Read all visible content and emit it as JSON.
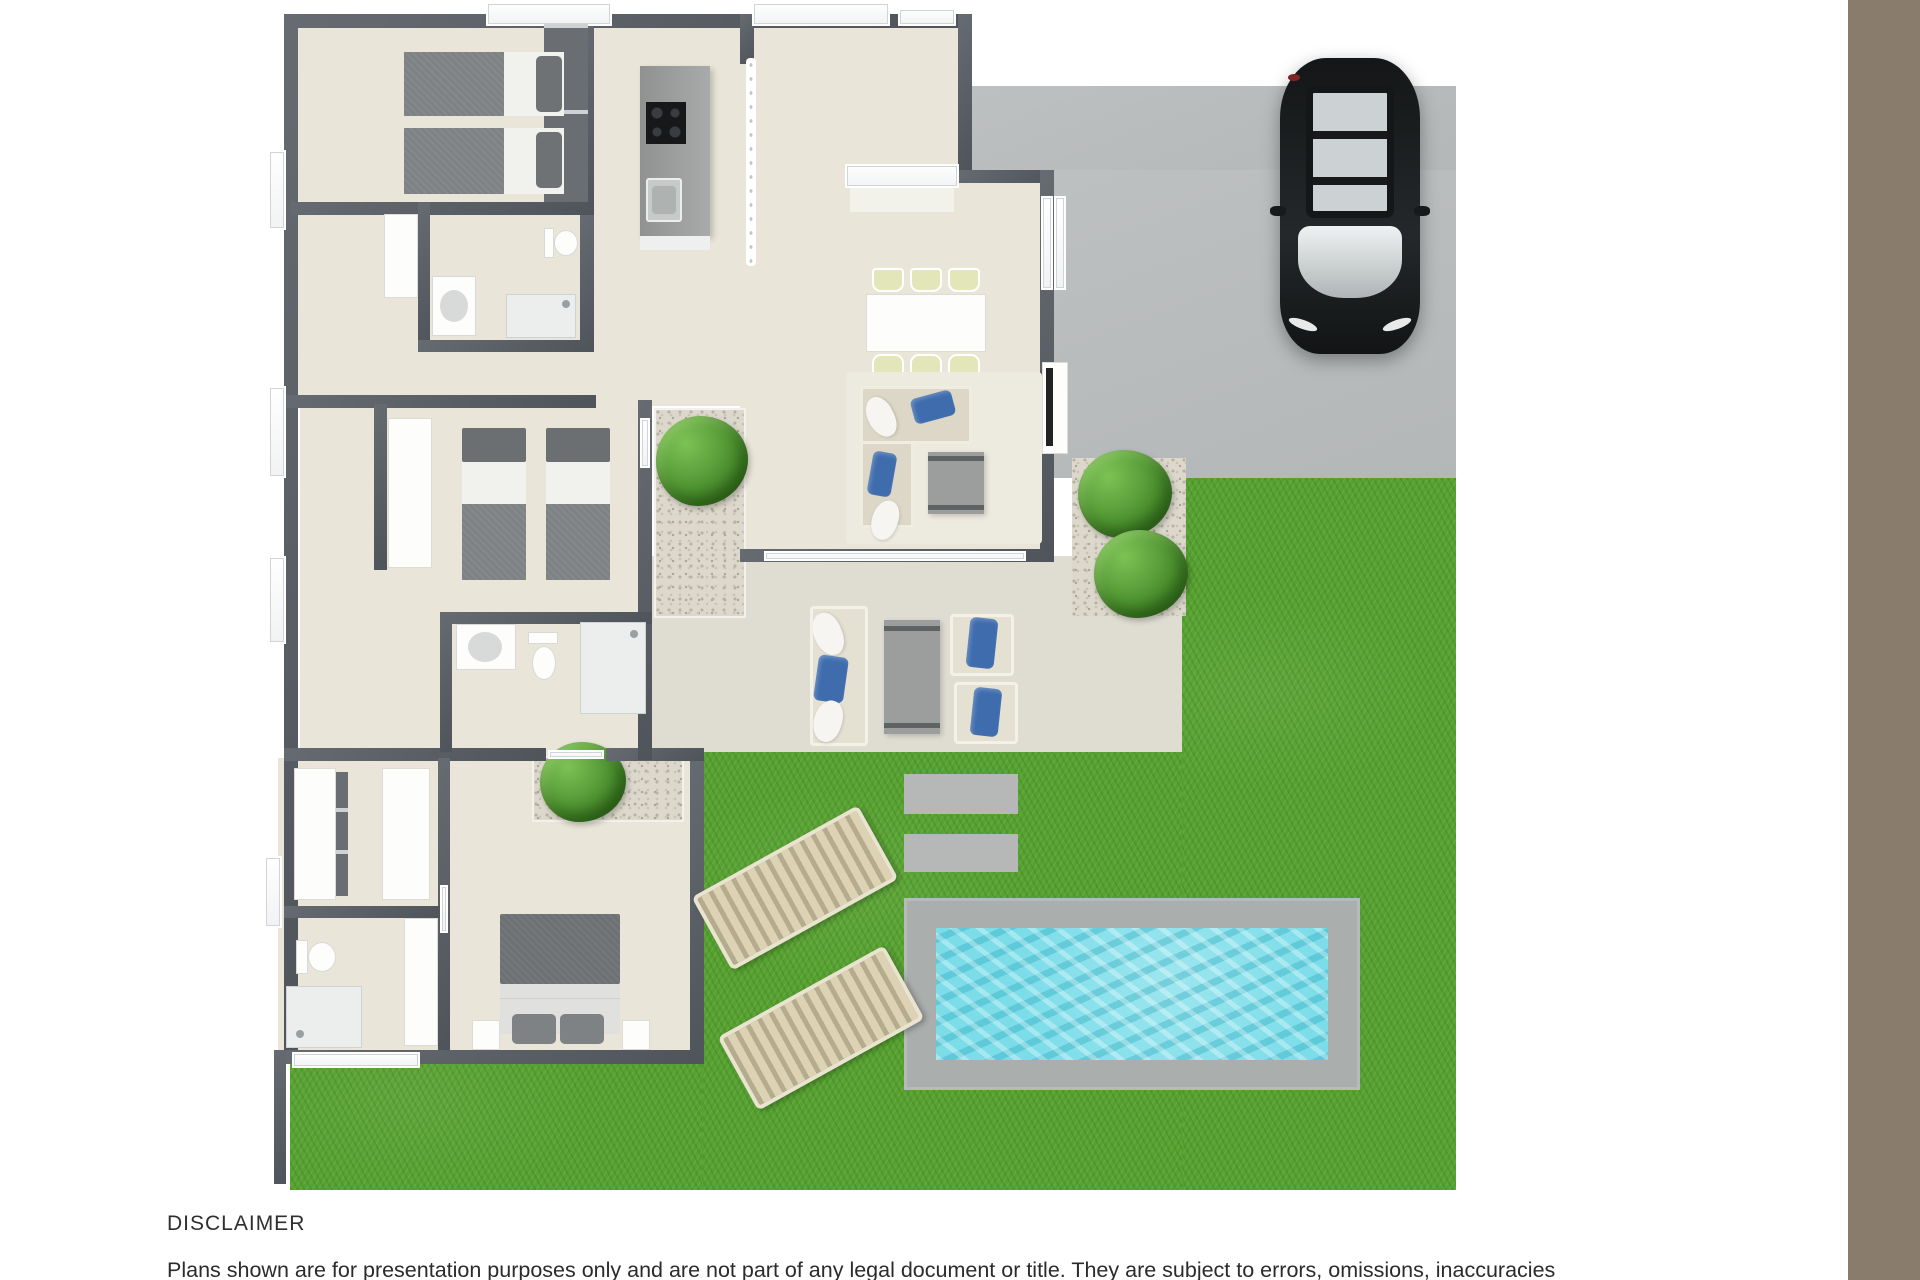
{
  "palette": {
    "page_bg": "#ffffff",
    "side_stripe": "#8a7c6d",
    "grass": "#56a130",
    "driveway": "#b9bcbd",
    "pool_water": "#7cdde9",
    "pool_deck": "#aaaeac",
    "wall": "#585d64",
    "floor": "#e9e5d8",
    "patio": "#dfddd2",
    "gravel": "#dcd8cc",
    "accent_blue": "#3e6cad",
    "car": "#1d1f20",
    "text": "#2f2f2f"
  },
  "disclaimer": {
    "title": "DISCLAIMER",
    "body": "Plans shown are for presentation purposes only and are not part of any legal document or title. They are subject to errors, omissions, inaccuracies"
  },
  "floor_plan": {
    "type": "3d-top-down-floor-plan-render",
    "areas": [
      "driveway",
      "front-entry",
      "kitchen",
      "dining-area",
      "living-room",
      "hallway",
      "courtyard-garden",
      "bedroom-1",
      "bathroom-1",
      "bedroom-2",
      "bathroom-2",
      "master-bedroom",
      "walk-in-robe",
      "ensuite",
      "patio",
      "backyard-lawn",
      "swimming-pool"
    ],
    "objects": {
      "car": 1,
      "single_beds": 4,
      "double_beds": 1,
      "sun_loungers": 2,
      "garden_bushes": 5,
      "dining_chairs": 6,
      "sofas": 2,
      "outdoor_armchairs": 2,
      "toilets": 3,
      "showers": 3,
      "kitchen_island_with_cooktop_and_sink": 1,
      "paving_pads": 2,
      "swimming_pool": 1
    }
  }
}
